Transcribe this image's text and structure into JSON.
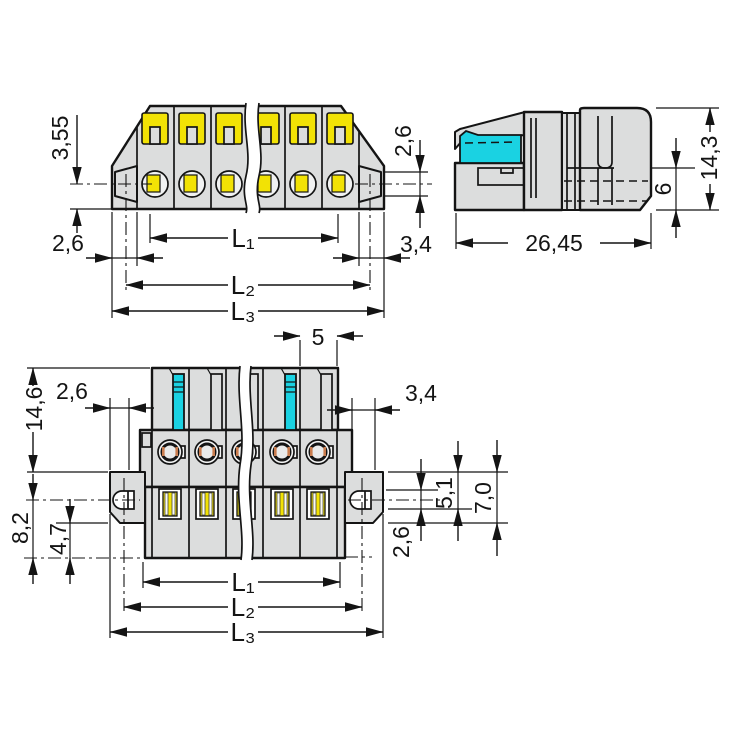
{
  "drawing": {
    "views": {
      "side_view": {
        "dims": {
          "d355": "3,55",
          "d26_left": "2,6",
          "d26_flange": "2,6",
          "d34": "3,4",
          "l1": "L₁",
          "l2": "L₂",
          "l3": "L₃"
        }
      },
      "profile_view": {
        "dims": {
          "w2645": "26,45",
          "h143": "14,3",
          "h6": "6"
        }
      },
      "front_view": {
        "dims": {
          "p5": "5",
          "d26_left": "2,6",
          "d34_right": "3,4",
          "h146": "14,6",
          "h82": "8,2",
          "h47": "4,7",
          "d51": "5,1",
          "d70": "7,0",
          "d26_hole": "2,6",
          "l1": "L₁",
          "l2": "L₂",
          "l3": "L₃"
        }
      }
    },
    "colors": {
      "background": "#ffffff",
      "body": "#dcdddd",
      "accent_cyan": "#1ad2e2",
      "accent_yellow": "#f2e205",
      "contact_orange": "#c97c4e",
      "line": "#141414"
    }
  }
}
